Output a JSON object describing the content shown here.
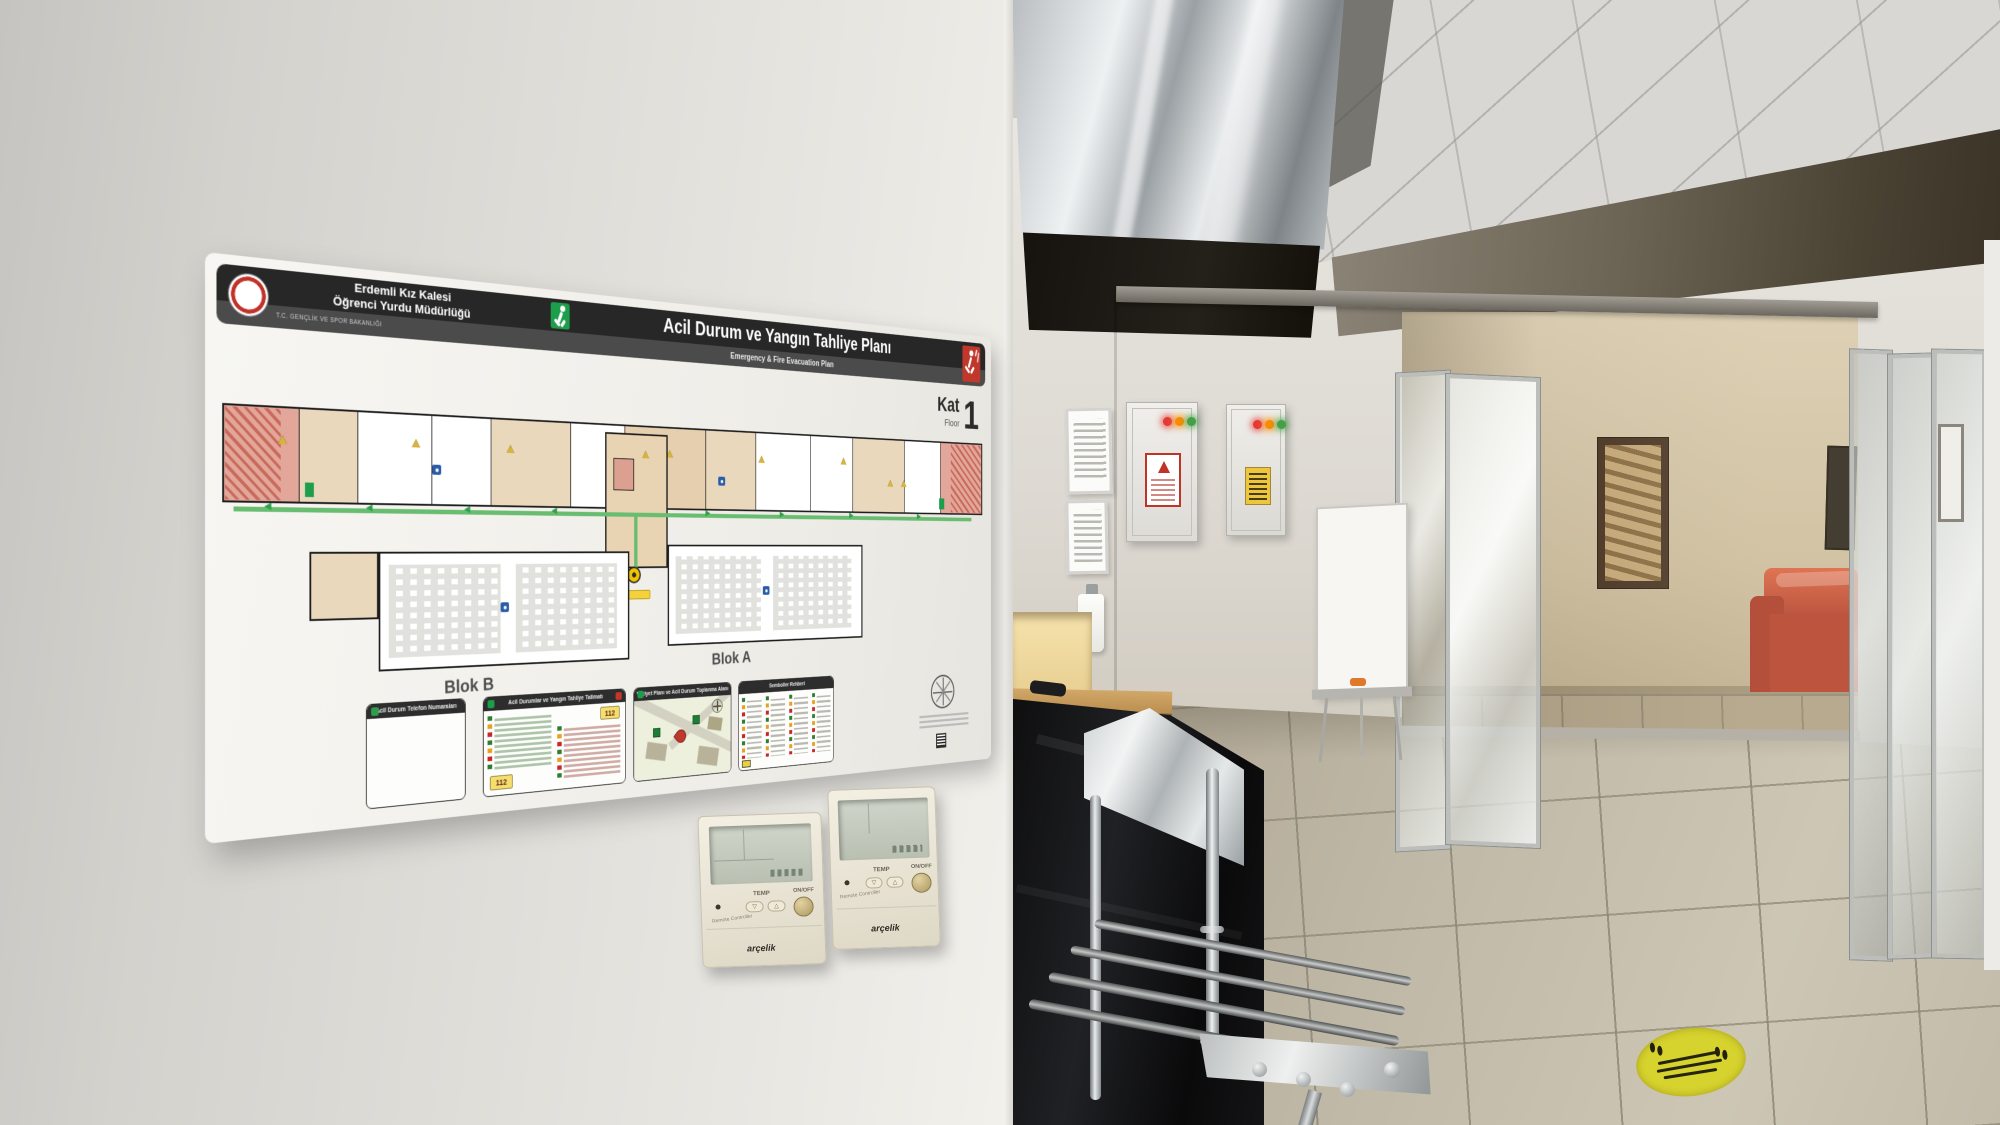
{
  "poster": {
    "org": {
      "line1": "Erdemli Kız Kalesi",
      "line2": "Öğrenci Yurdu Müdürlüğü",
      "ministry": "T.C. GENÇLİK VE SPOR BAKANLIĞI"
    },
    "title": "Acil Durum ve Yangın Tahliye Planı",
    "subtitle": "Emergency & Fire Evacuation Plan",
    "floor": {
      "kat_label": "Kat",
      "floor_label": "Floor",
      "number": "1"
    },
    "blocks": {
      "block_b": "Blok B",
      "block_a": "Blok A"
    },
    "panels": {
      "phones_title": "Acil Durum Telefon Numaraları",
      "instructions_title": "Acil Durumlar ve Yangın Tahliye Talimatı",
      "siteplan_title": "Vaziyet Planı ve Acil Durum Toplanma Alanı",
      "symbols_title": "Semboller Rehberi",
      "emergency_number": "112"
    }
  },
  "thermostat": {
    "brand": "arçelik",
    "temp_label": "TEMP",
    "power_label": "ON/OFF",
    "remote_label": "Remote Controller"
  },
  "colors": {
    "exit_green": "#1d9e4b",
    "fire_red": "#c0372b",
    "route_green": "#69bd70",
    "you_are_here_yellow": "#f2c500",
    "led_red": "#e53935",
    "led_amber": "#fb8c00",
    "led_green": "#43a047",
    "couch_red": "#c24a36",
    "floor_sticker_yellow": "#d6d22e"
  }
}
